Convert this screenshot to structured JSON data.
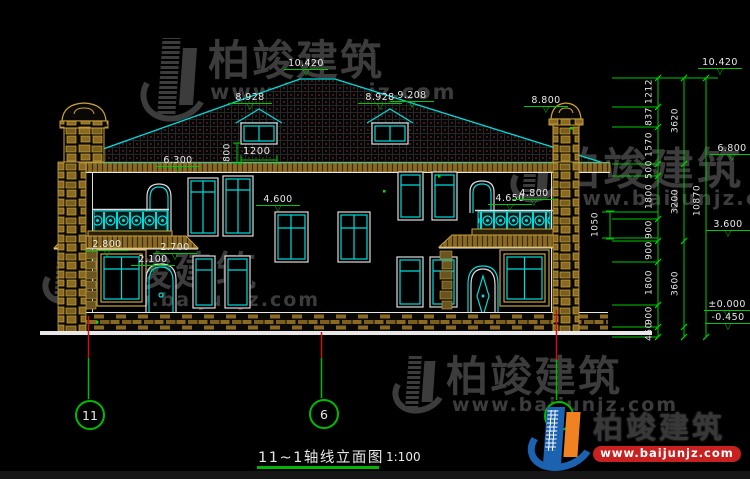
{
  "colors": {
    "background": "#000000",
    "line_cyan": "#00dcdc",
    "dim_green": "#00c800",
    "line_white": "#e8e8e8",
    "stone_tan": "#c8a23c",
    "axis_red": "#cc1111",
    "watermark_gray": "#3c3c3c",
    "logo_blue": "#1b63b0",
    "logo_orange": "#f08222",
    "banner_red": "#c92020"
  },
  "watermark": {
    "brand": "柏竣建筑",
    "url": "www.baijunjz.com"
  },
  "footer_logo": {
    "brand": "柏竣建筑",
    "url": "www.baijunjz.com"
  },
  "title_block": {
    "title": "11~1轴线立面图",
    "scale": "1:100"
  },
  "axis_bubbles": {
    "left": "11",
    "center": "6",
    "right": "1"
  },
  "glyphs": {
    "elev_triangle": "▽"
  },
  "elevation_markers": {
    "ridge": "10.420",
    "dormer_left": "8.928",
    "dormer_right": "8.928",
    "roof_right": "9.208",
    "chimney_right": "8.800",
    "eave_left": "6.300",
    "stair_window": "4.600",
    "balcony_right_a": "4.650",
    "balcony_right_b": "4.800",
    "porch_left_a": "2.800",
    "porch_left_b": "2.700",
    "entry_left": "2.100",
    "right_top": "10.420",
    "right_eave": "6.800",
    "right_floor": "3.600",
    "right_zero": "±0.000",
    "right_ground": "-0.450"
  },
  "linear_dims": {
    "dormer_width": "1200",
    "dormer_sill": "800",
    "balcony_rail": "1050",
    "right_chain": {
      "segments": [
        "1212",
        "837",
        "1570",
        "500",
        "1800",
        "900",
        "900",
        "1800",
        "900",
        "450"
      ],
      "subtotals": [
        "3620",
        "3200",
        "3600"
      ],
      "total": "10870"
    }
  }
}
